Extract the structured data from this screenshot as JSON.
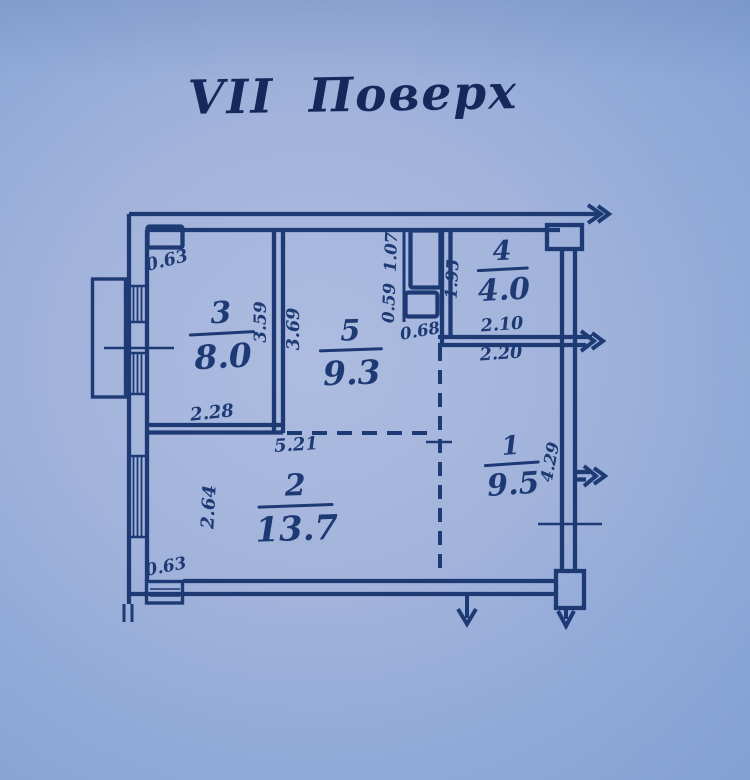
{
  "title": "VII  Поверх",
  "colors": {
    "paper": "#a2b3db",
    "ink": "#1e3a74",
    "title_ink": "#15285c"
  },
  "rooms": {
    "r1": {
      "number": "1",
      "area": "9.5"
    },
    "r2": {
      "number": "2",
      "area": "13.7"
    },
    "r3": {
      "number": "3",
      "area": "8.0"
    },
    "r4": {
      "number": "4",
      "area": "4.0"
    },
    "r5": {
      "number": "5",
      "area": "9.3"
    }
  },
  "dimensions": {
    "vent_top_left": "0.63",
    "room3_right": "3.59",
    "room5_left": "3.69",
    "room3_bottom": "2.28",
    "room2_top": "5.21",
    "room2_left": "2.64",
    "column_bottom_left": "0.63",
    "shaft_upper": "1.07",
    "shaft_lower": "0.59",
    "shaft_bottom": "0.68",
    "room4_left": "1.95",
    "room4_bottom_inner": "2.10",
    "room4_bottom_outer": "2.20",
    "room1_right": "4.29"
  },
  "icons": {
    "arrows": [
      "arrow-right-top",
      "arrow-right-middle",
      "arrow-right-lower",
      "arrow-down-bottom-left",
      "arrow-down-bottom-right"
    ]
  }
}
